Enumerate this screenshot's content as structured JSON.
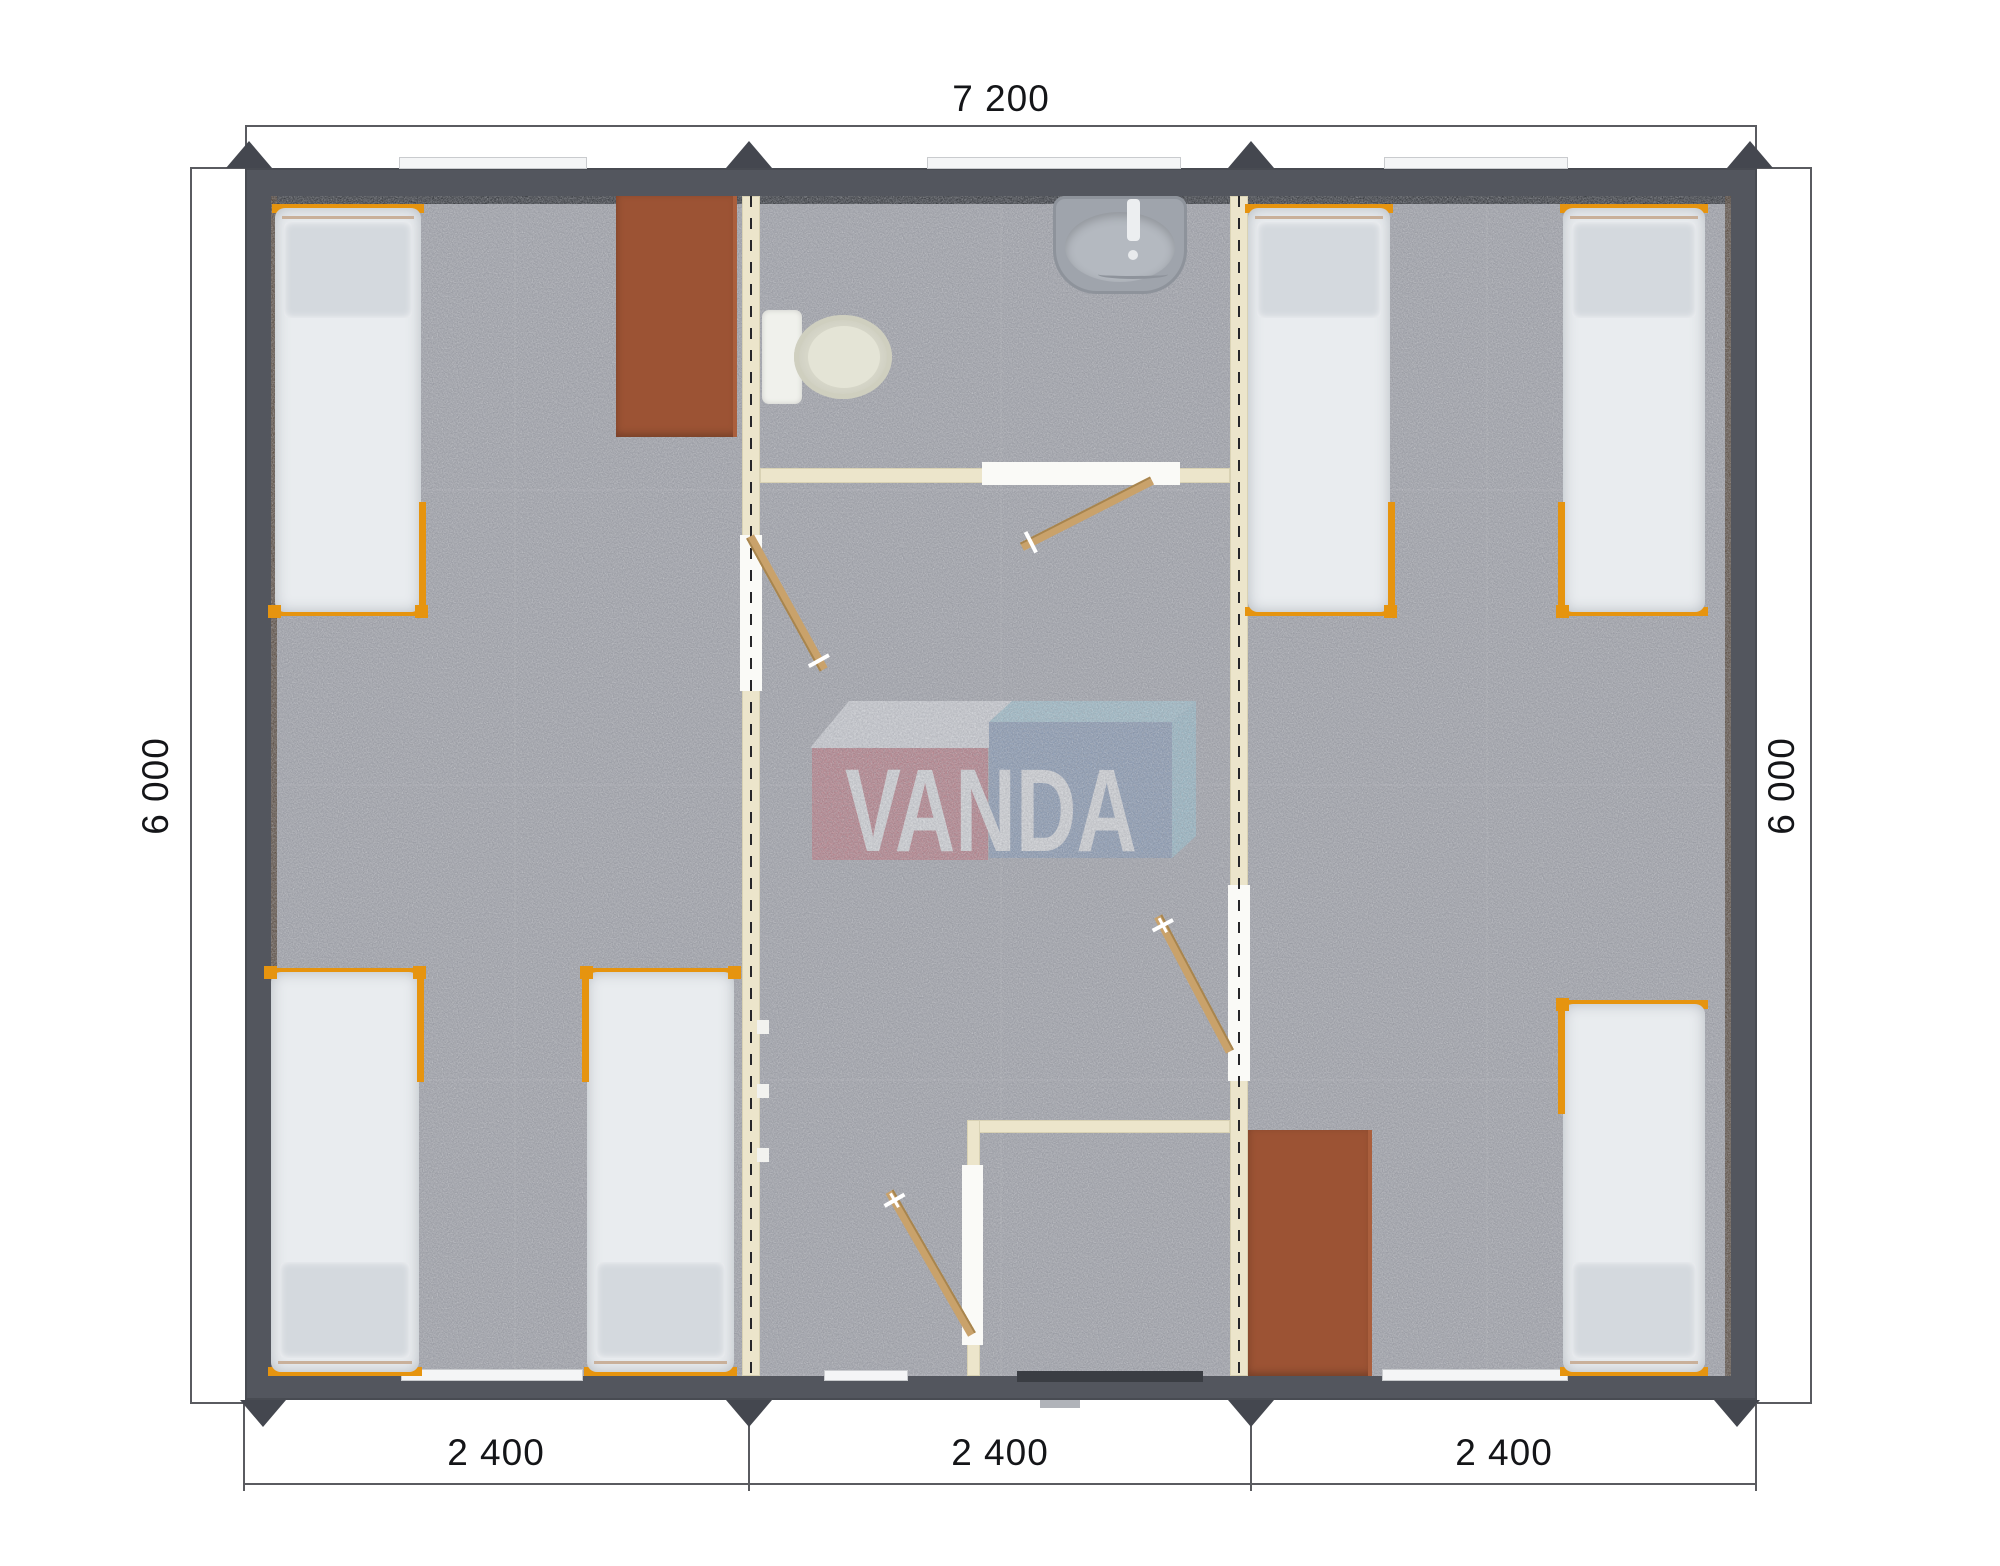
{
  "watermark": {
    "text": "VANDA"
  },
  "dimensions": {
    "top": "7 200",
    "left": "6 000",
    "right": "6 000",
    "bottom": [
      "2 400",
      "2 400",
      "2 400"
    ]
  },
  "plan": {
    "modules": 3,
    "beds_total": 6,
    "left_bedroom_beds": 3,
    "right_bedroom_beds": 3,
    "tables": 2,
    "bathroom_fixtures": [
      "toilet",
      "sink"
    ],
    "doors": [
      "bathroom-door",
      "left-bedroom-door",
      "right-bedroom-door",
      "entrance-lobby-door"
    ]
  },
  "colors": {
    "wall": "#53565e",
    "floor": "#a0a2a9",
    "partition": "#ece5cb",
    "bed_frame_orange": "#e6940f",
    "furniture_brown": "#9c5334",
    "door_wood": "#c9a26b",
    "logo_red": "#c4626c",
    "logo_blue": "#7590b6",
    "logo_light_blue": "#9ccede"
  }
}
